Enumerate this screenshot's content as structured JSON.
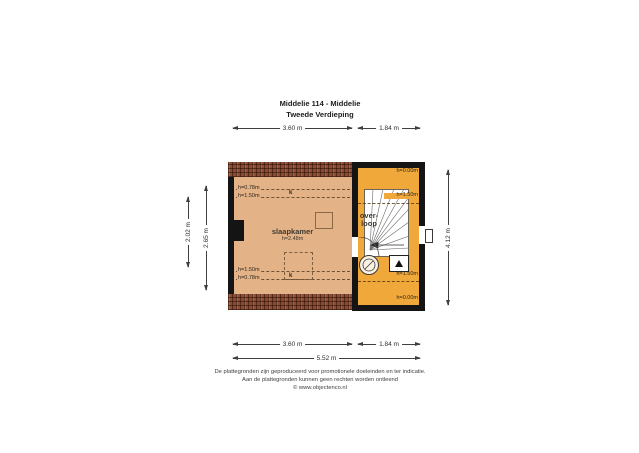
{
  "title": {
    "line1": "Middelie 114 - Middelie",
    "line2": "Tweede Verdieping"
  },
  "rooms": {
    "slaapkamer": {
      "name": "slaapkamer",
      "height": "h=2.48m"
    },
    "overloop": {
      "name_line1": "over-",
      "name_line2": "loop"
    }
  },
  "annotations": {
    "bedroom_top_1": "h=0.78m",
    "bedroom_top_2": "h=1.50m",
    "bedroom_bottom_1": "h=1.50m",
    "bedroom_bottom_2": "h=0.78m",
    "k_top": "k",
    "k_bottom": "k",
    "landing_top_1": "h=0.00m",
    "landing_top_2": "h=1.50m",
    "landing_bottom_1": "h=1.50m",
    "landing_bottom_2": "h=0.00m"
  },
  "dimensions": {
    "top_bedroom": "3.60 m",
    "top_landing": "1.84 m",
    "left_inner": "2.02 m",
    "left_outer": "2.65 m",
    "right_total": "4.12 m",
    "bottom_bedroom": "3.60 m",
    "bottom_landing": "1.84 m",
    "bottom_total": "5.52 m"
  },
  "footer": {
    "line1": "De plattegronden zijn geproduceerd voor promotionele doeleinden en ter indicatie.",
    "line2": "Aan de plattegronden kunnen geen rechten worden ontleend",
    "line3": "© www.objectenco.nl"
  },
  "icons": {
    "stairs": "staircase-winder",
    "ventilation": "ventilation-fan",
    "boiler": "boiler-triangle",
    "door": "door-swing-arc"
  },
  "colors": {
    "bedroom_fill": "#e3b287",
    "landing_fill": "#f0a83b",
    "brick": "#8a4c35",
    "wall": "#141414",
    "dimension_line": "#3f3f3f"
  }
}
